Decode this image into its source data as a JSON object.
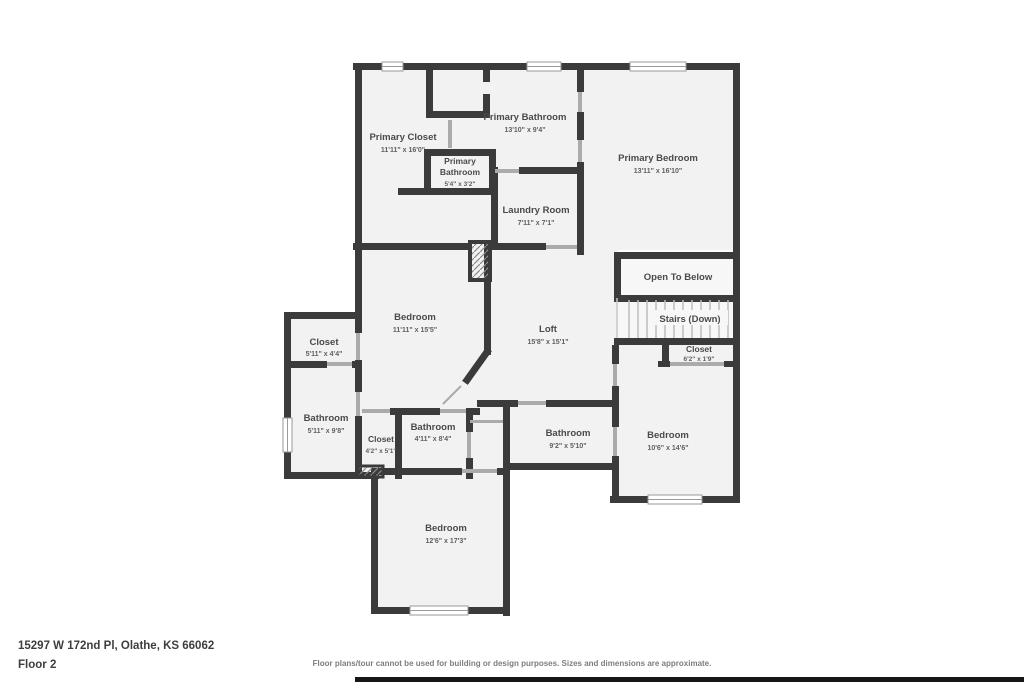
{
  "rooms": {
    "primary_closet": {
      "name": "Primary Closet",
      "dims": "11'11\" x 16'0\""
    },
    "primary_bathroom_upper": {
      "name": "Primary Bathroom",
      "dims": "13'10\" x 9'4\""
    },
    "primary_bathroom_small": {
      "name_line1": "Primary",
      "name_line2": "Bathroom",
      "dims": "5'4\" x 3'2\""
    },
    "primary_bedroom": {
      "name": "Primary Bedroom",
      "dims": "13'11\" x 16'10\""
    },
    "laundry_room": {
      "name": "Laundry Room",
      "dims": "7'11\" x 7'1\""
    },
    "open_to_below": {
      "name": "Open To Below"
    },
    "stairs": {
      "name": "Stairs (Down)"
    },
    "closet_hall": {
      "name": "Closet",
      "dims": "6'2\" x 1'9\""
    },
    "bedroom_left": {
      "name": "Bedroom",
      "dims": "11'11\" x 15'5\""
    },
    "loft": {
      "name": "Loft",
      "dims": "15'8\" x 15'1\""
    },
    "closet_left": {
      "name": "Closet",
      "dims": "5'11\" x 4'4\""
    },
    "bathroom_left": {
      "name": "Bathroom",
      "dims": "5'11\" x 9'8\""
    },
    "closet_small": {
      "name": "Closet",
      "dims": "4'2\" x 5'1\""
    },
    "bathroom_mid": {
      "name": "Bathroom",
      "dims": "4'11\" x 8'4\""
    },
    "bathroom_right": {
      "name": "Bathroom",
      "dims": "9'2\" x 5'10\""
    },
    "bedroom_right": {
      "name": "Bedroom",
      "dims": "10'6\" x 14'6\""
    },
    "bedroom_bottom": {
      "name": "Bedroom",
      "dims": "12'6\" x 17'3\""
    }
  },
  "footer": {
    "address": "15297 W 172nd Pl, Olathe, KS 66062",
    "floor_label": "Floor 2",
    "disclaimer": "Floor plans/tour cannot be used for building or design purposes. Sizes and dimensions are approximate."
  },
  "colors": {
    "wall": "#3b3b3b",
    "room_fill": "#f2f2f2",
    "label_text": "#4a4a4a",
    "background": "#ffffff"
  }
}
